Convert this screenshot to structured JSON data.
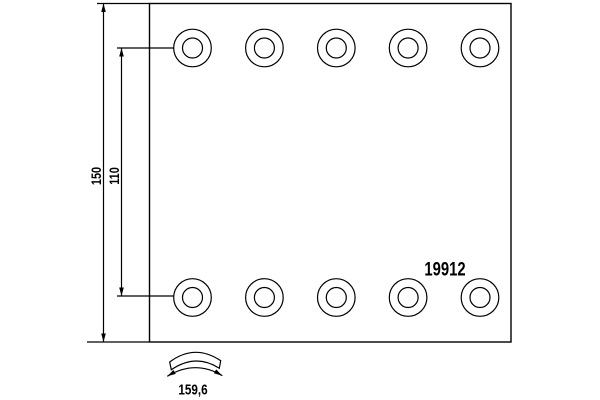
{
  "drawing": {
    "type": "brake-lining-technical-drawing",
    "part_number": "19912",
    "dimensions": {
      "overall_height": "150",
      "hole_row_spacing": "110",
      "arc_width": "159,6"
    },
    "holes": {
      "rows": 2,
      "per_row": 5
    },
    "colors": {
      "line": "#000000",
      "background": "#ffffff"
    }
  }
}
